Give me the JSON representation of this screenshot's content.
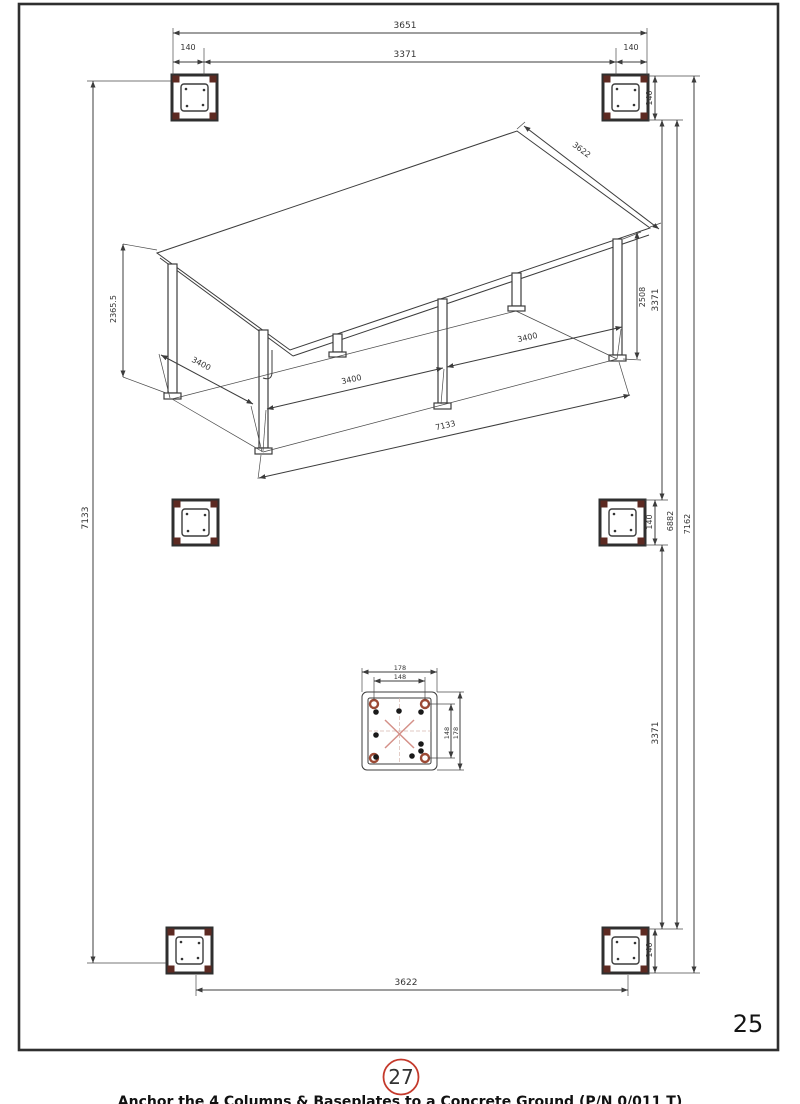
{
  "page": {
    "number": "25",
    "step_badge": "27",
    "footer_caption": "Anchor the 4 Columns & Baseplates to a Concrete Ground (P/N 0/011 T)"
  },
  "colors": {
    "line": "#3c3c3c",
    "post_corner_red": "#5d2a22",
    "plate_hole_red": "#9c4a35",
    "cross_red": "#d49088",
    "badge_red": "#c4392b"
  },
  "dims": {
    "top": {
      "overall": "3651",
      "inner": "3371",
      "left_offset": "140",
      "right_offset": "140"
    },
    "right": {
      "top_offset": "140",
      "upper_span": "3371",
      "mid_offset": "140",
      "lower_span": "3371",
      "inner_total": "6882",
      "outer_total": "7162",
      "bottom_offset": "140"
    },
    "left": {
      "total": "7133"
    },
    "bottom": {
      "span": "3622"
    },
    "iso": {
      "height_left": "2365.5",
      "depth_left": "3400",
      "bay_front_1": "3400",
      "bay_front_2": "3400",
      "front_total": "7133",
      "roof_depth": "3622",
      "height_right": "2508"
    },
    "plate": {
      "outer_width": "178",
      "inner_width": "148",
      "outer_height": "178",
      "inner_height": "148"
    }
  }
}
